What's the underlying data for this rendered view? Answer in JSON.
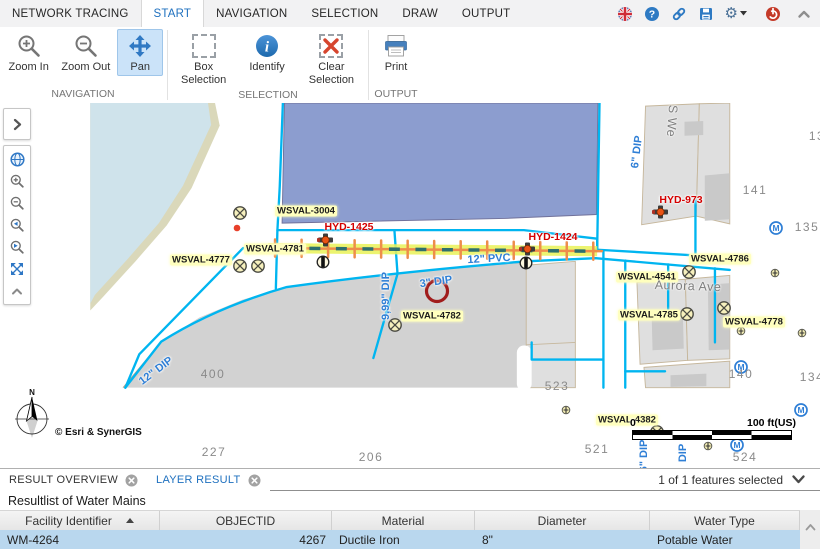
{
  "ribbon": {
    "tabs": [
      {
        "label": "NETWORK TRACING",
        "active": false
      },
      {
        "label": "START",
        "active": true
      },
      {
        "label": "NAVIGATION",
        "active": false
      },
      {
        "label": "SELECTION",
        "active": false
      },
      {
        "label": "DRAW",
        "active": false
      },
      {
        "label": "OUTPUT",
        "active": false
      }
    ],
    "groups": [
      {
        "name": "NAVIGATION",
        "buttons": [
          {
            "label": "Zoom In"
          },
          {
            "label": "Zoom Out"
          },
          {
            "label": "Pan",
            "active": true
          }
        ]
      },
      {
        "name": "SELECTION",
        "buttons": [
          {
            "label": "Box Selection"
          },
          {
            "label": "Identify"
          },
          {
            "label": "Clear Selection"
          }
        ]
      },
      {
        "name": "OUTPUT",
        "buttons": [
          {
            "label": "Print"
          }
        ]
      }
    ]
  },
  "quickbar": {
    "icons": [
      "language-flag",
      "help",
      "link",
      "save",
      "settings",
      "power",
      "collapse-ribbon"
    ]
  },
  "colors": {
    "accent_blue": "#1e70bf",
    "pipe_cyan": "#00b5f0",
    "trace_highlight": "#e9f257",
    "trace_dash": "#2e6f6e",
    "trace_tick": "#ee8d4b",
    "selected_row": "#b9d7ee",
    "hydrant_label_red": "#d40000"
  },
  "map": {
    "attribution": "© Esri & SynerGIS",
    "compass_label": "N",
    "scalebar": {
      "start": "0",
      "end": "100 ft(US)"
    },
    "labels": [
      {
        "text": "WSVAL-3004",
        "x": 306,
        "y": 211,
        "kind": "valve"
      },
      {
        "text": "WSVAL-4777",
        "x": 201,
        "y": 260,
        "kind": "valve"
      },
      {
        "text": "WSVAL-4781",
        "x": 275,
        "y": 249,
        "kind": "valve"
      },
      {
        "text": "WSVAL-4782",
        "x": 432,
        "y": 316,
        "kind": "valve"
      },
      {
        "text": "WSVAL-4541",
        "x": 647,
        "y": 277,
        "kind": "valve"
      },
      {
        "text": "WSVAL-4786",
        "x": 720,
        "y": 259,
        "kind": "valve"
      },
      {
        "text": "WSVAL-4785",
        "x": 649,
        "y": 315,
        "kind": "valve"
      },
      {
        "text": "WSVAL-4778",
        "x": 754,
        "y": 322,
        "kind": "valve"
      },
      {
        "text": "WSVAL-4382",
        "x": 627,
        "y": 420,
        "kind": "valve"
      },
      {
        "text": "HYD-1425",
        "x": 349,
        "y": 227,
        "kind": "hydrant"
      },
      {
        "text": "HYD-1424",
        "x": 553,
        "y": 237,
        "kind": "hydrant"
      },
      {
        "text": "HYD-973",
        "x": 681,
        "y": 200,
        "kind": "hydrant"
      },
      {
        "text": "12\" PVC",
        "x": 489,
        "y": 259,
        "kind": "pipe",
        "rot": -3
      },
      {
        "text": "3\" DIP",
        "x": 436,
        "y": 282,
        "kind": "pipe",
        "rot": -8
      },
      {
        "text": "9,99\" DIP",
        "x": 386,
        "y": 296,
        "kind": "pipe",
        "rot": -90
      },
      {
        "text": "6\" DIP",
        "x": 637,
        "y": 152,
        "kind": "pipe",
        "rot": -83
      },
      {
        "text": "12\" DIP",
        "x": 156,
        "y": 371,
        "kind": "pipe",
        "rot": -37
      },
      {
        "text": "6\" DIP",
        "x": 644,
        "y": 456,
        "kind": "pipe",
        "rot": -90
      },
      {
        "text": "DIP",
        "x": 683,
        "y": 453,
        "kind": "pipe",
        "rot": -90
      },
      {
        "text": "Aurora Ave",
        "x": 688,
        "y": 286,
        "kind": "street",
        "rot": 2
      },
      {
        "text": "S We",
        "x": 672,
        "y": 121,
        "kind": "street",
        "rot": 94
      },
      {
        "text": "141",
        "x": 755,
        "y": 190,
        "kind": "parcel"
      },
      {
        "text": "135",
        "x": 807,
        "y": 227,
        "kind": "parcel"
      },
      {
        "text": "13",
        "x": 817,
        "y": 136,
        "kind": "parcel"
      },
      {
        "text": "140",
        "x": 741,
        "y": 374,
        "kind": "parcel"
      },
      {
        "text": "134",
        "x": 812,
        "y": 377,
        "kind": "parcel"
      },
      {
        "text": "400",
        "x": 213,
        "y": 374,
        "kind": "parcel"
      },
      {
        "text": "227",
        "x": 214,
        "y": 452,
        "kind": "parcel"
      },
      {
        "text": "206",
        "x": 371,
        "y": 457,
        "kind": "parcel"
      },
      {
        "text": "523",
        "x": 557,
        "y": 386,
        "kind": "parcel"
      },
      {
        "text": "521",
        "x": 597,
        "y": 449,
        "kind": "parcel"
      },
      {
        "text": "524",
        "x": 745,
        "y": 457,
        "kind": "parcel"
      }
    ],
    "markers": [
      {
        "kind": "valve",
        "x": 240,
        "y": 213
      },
      {
        "kind": "valve",
        "x": 240,
        "y": 266
      },
      {
        "kind": "valve",
        "x": 258,
        "y": 266
      },
      {
        "kind": "valve",
        "x": 395,
        "y": 325
      },
      {
        "kind": "valve",
        "x": 689,
        "y": 272
      },
      {
        "kind": "valve",
        "x": 687,
        "y": 314
      },
      {
        "kind": "valve",
        "x": 724,
        "y": 308
      },
      {
        "kind": "valve",
        "x": 657,
        "y": 432
      },
      {
        "kind": "small-valve",
        "x": 775,
        "y": 273
      },
      {
        "kind": "small-valve",
        "x": 741,
        "y": 331
      },
      {
        "kind": "small-valve",
        "x": 802,
        "y": 333
      },
      {
        "kind": "small-valve",
        "x": 566,
        "y": 410
      },
      {
        "kind": "small-valve",
        "x": 708,
        "y": 446
      },
      {
        "kind": "meter",
        "x": 776,
        "y": 228
      },
      {
        "kind": "meter",
        "x": 741,
        "y": 367
      },
      {
        "kind": "meter",
        "x": 801,
        "y": 410
      },
      {
        "kind": "meter",
        "x": 737,
        "y": 445
      },
      {
        "kind": "hydrant",
        "x": 326,
        "y": 240
      },
      {
        "kind": "hydrant",
        "x": 528,
        "y": 249
      },
      {
        "kind": "hydrant",
        "x": 661,
        "y": 212
      },
      {
        "kind": "check-valve",
        "x": 323,
        "y": 262
      },
      {
        "kind": "check-valve",
        "x": 526,
        "y": 263
      },
      {
        "kind": "red-dot",
        "x": 237,
        "y": 228
      },
      {
        "kind": "selection-circle",
        "x": 437,
        "y": 291
      }
    ]
  },
  "results_panel": {
    "tabs": [
      {
        "label": "RESULT OVERVIEW",
        "active": false
      },
      {
        "label": "LAYER RESULT",
        "active": true
      }
    ],
    "selection_status": "1 of 1 features selected",
    "title": "Resultlist of Water Mains",
    "table": {
      "columns": [
        {
          "label": "Facility Identifier",
          "sort": "asc"
        },
        {
          "label": "OBJECTID"
        },
        {
          "label": "Material"
        },
        {
          "label": "Diameter"
        },
        {
          "label": "Water Type"
        }
      ],
      "rows": [
        {
          "cells": [
            "WM-4264",
            "4267",
            "Ductile Iron",
            "8\"",
            "Potable Water"
          ],
          "selected": true
        }
      ]
    }
  }
}
